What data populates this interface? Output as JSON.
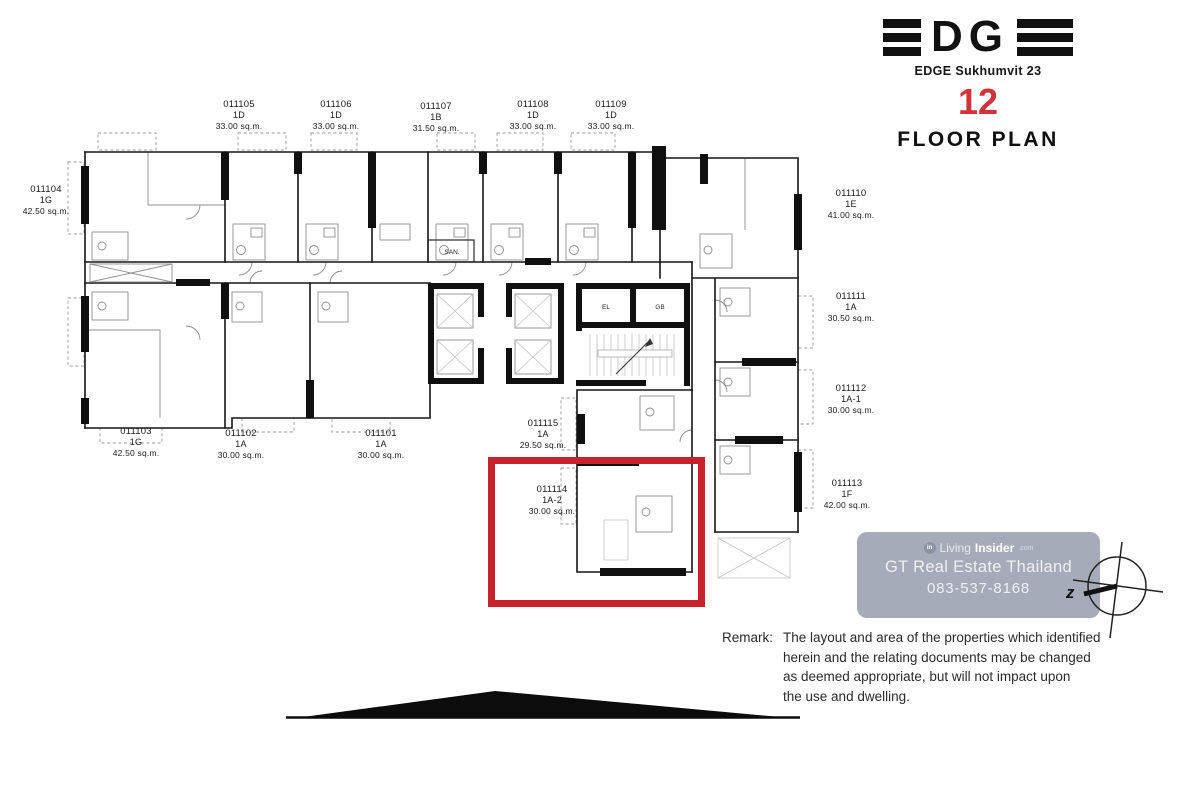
{
  "header": {
    "logo_letters": "DG",
    "project_name": "EDGE Sukhumvit 23",
    "floor_number": "12",
    "title": "FLOOR PLAN"
  },
  "units": [
    {
      "id": "011101",
      "type": "1A",
      "area": "30.00 sq.m."
    },
    {
      "id": "011102",
      "type": "1A",
      "area": "30.00 sq.m."
    },
    {
      "id": "011103",
      "type": "1G",
      "area": "42.50 sq.m."
    },
    {
      "id": "011104",
      "type": "1G",
      "area": "42.50 sq.m."
    },
    {
      "id": "011105",
      "type": "1D",
      "area": "33.00 sq.m."
    },
    {
      "id": "011106",
      "type": "1D",
      "area": "33.00 sq.m."
    },
    {
      "id": "011107",
      "type": "1B",
      "area": "31.50 sq.m."
    },
    {
      "id": "011108",
      "type": "1D",
      "area": "33.00 sq.m."
    },
    {
      "id": "011109",
      "type": "1D",
      "area": "33.00 sq.m."
    },
    {
      "id": "011110",
      "type": "1E",
      "area": "41.00 sq.m."
    },
    {
      "id": "011111",
      "type": "1A",
      "area": "30.50 sq.m."
    },
    {
      "id": "011112",
      "type": "1A-1",
      "area": "30.00 sq.m."
    },
    {
      "id": "011113",
      "type": "1F",
      "area": "42.00 sq.m."
    },
    {
      "id": "011114",
      "type": "1A-2",
      "area": "30.00 sq.m."
    },
    {
      "id": "011115",
      "type": "1A",
      "area": "29.50 sq.m."
    }
  ],
  "highlight": {
    "unit_id": "011114",
    "color": "#c8232c"
  },
  "plan_labels": {
    "san": "SAN.",
    "el": "EL",
    "gb": "GB"
  },
  "compass": {
    "letter": "z"
  },
  "watermark": {
    "brand_living": "Living",
    "brand_insider": "Insider",
    "brand_tld": ".com",
    "company": "GT Real Estate Thailand",
    "phone": "083-537-8168"
  },
  "remark": {
    "label": "Remark:",
    "lines": [
      "The layout and area of the properties which identified",
      "herein and the relating documents may be changed",
      "as deemed appropriate, but will not impact upon",
      "the use and dwelling."
    ]
  },
  "colors": {
    "highlight_red": "#c8232c",
    "floor_number_red": "#cf3338",
    "watermark_bg": "#a6abb9",
    "ink": "#111111"
  }
}
